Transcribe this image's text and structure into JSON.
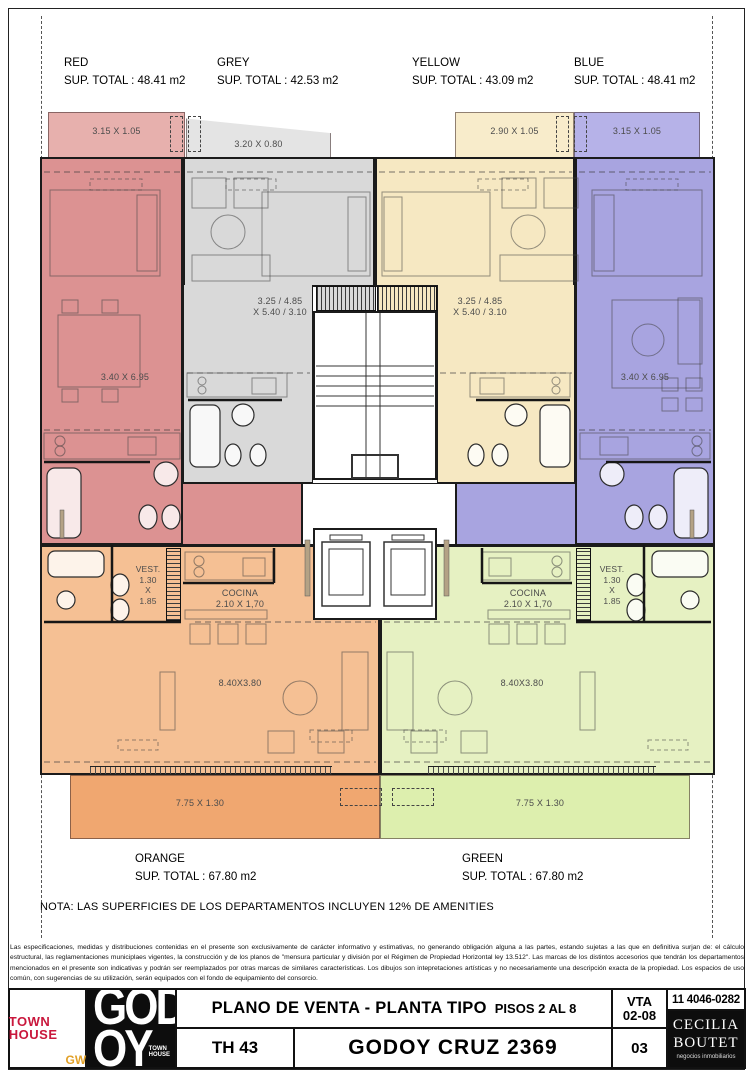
{
  "colors": {
    "red": "#dc9292",
    "red-l": "#e7b0ad",
    "grey": "#d9d9d9",
    "grey-l": "#e4e4e4",
    "yellow": "#f6e8c2",
    "yellow-l": "#f8eccb",
    "blue": "#a8a4e0",
    "blue-l": "#b6b2e8",
    "orange": "#f5c094",
    "orange-d": "#f0a770",
    "green": "#e6f1c2",
    "green-d": "#ddefae"
  },
  "header": {
    "units": [
      {
        "name": "RED",
        "sup": "SUP. TOTAL : 48.41 m2"
      },
      {
        "name": "GREY",
        "sup": "SUP. TOTAL : 42.53 m2"
      },
      {
        "name": "YELLOW",
        "sup": "SUP. TOTAL : 43.09 m2"
      },
      {
        "name": "BLUE",
        "sup": "SUP. TOTAL : 48.41 m2"
      }
    ]
  },
  "footer_units": [
    {
      "name": "ORANGE",
      "sup": "SUP. TOTAL : 67.80 m2"
    },
    {
      "name": "GREEN",
      "sup": "SUP. TOTAL : 67.80 m2"
    }
  ],
  "plan": {
    "balconies": {
      "red": "3.15 X 1.05",
      "grey": "3.20 X 0.80",
      "yellow": "2.90 X 1.05",
      "blue": "3.15 X 1.05"
    },
    "rooms": {
      "red": "3.40 X 6.95",
      "blue": "3.40 X 6.95",
      "mid1": "3.25 / 4.85",
      "mid2": "X 5.40 / 3.10",
      "living": "8.40X3.80",
      "balcony": "7.75 X 1.30",
      "vest": [
        "VEST.",
        "1.30",
        "X",
        "1.85"
      ],
      "cocina1": "COCINA",
      "cocina2": "2.10 X 1,70"
    }
  },
  "nota": "NOTA: LAS SUPERFICIES DE LOS DEPARTAMENTOS INCLUYEN 12% DE AMENITIES",
  "disclaimer": "Las especificaciones, medidas y distribuciones contenidas en el presente son exclusivamente de carácter informativo y estimativas, no generando obligación alguna a las partes, estando sujetas a las que en definitiva surjan de: el cálculo estructural, las reglamentaciones municiplaes vigentes, la construcción y de los planos de \"mensura particular y división por el Régimen de Propiedad Horizontal ley 13.512\". Las marcas de los distintos accesorios que tendrán los departamentos mencionados en el presente son indicativas y podrán ser reemplazados por otras marcas de similares características. Los dibujos son intepretaciones artísticas y no necesariamente una descripción exacta de la propiedad. Los espacios de uso común, con sugerencias de su utilización, serán equipados con el fondo de equipamiento del consorcio.",
  "titleblock": {
    "logo_town": "TOWN",
    "logo_house": "HOUSE",
    "logo_gw": "GW",
    "godoy_line1": "GOD",
    "godoy_line2": "OY",
    "godoy_small1": "TOWN",
    "godoy_small2": "HOUSE",
    "title": "PLANO DE VENTA  -  PLANTA TIPO",
    "title_sub": "PISOS 2 AL 8",
    "code": "TH 43",
    "address": "GODOY CRUZ  2369",
    "vta1": "VTA",
    "vta2": "02-08",
    "sheet": "03",
    "phone": "11 4046-0282",
    "agent1": "CECILIA",
    "agent2": "BOUTET",
    "agent3": "negocios inmobiliarios"
  }
}
